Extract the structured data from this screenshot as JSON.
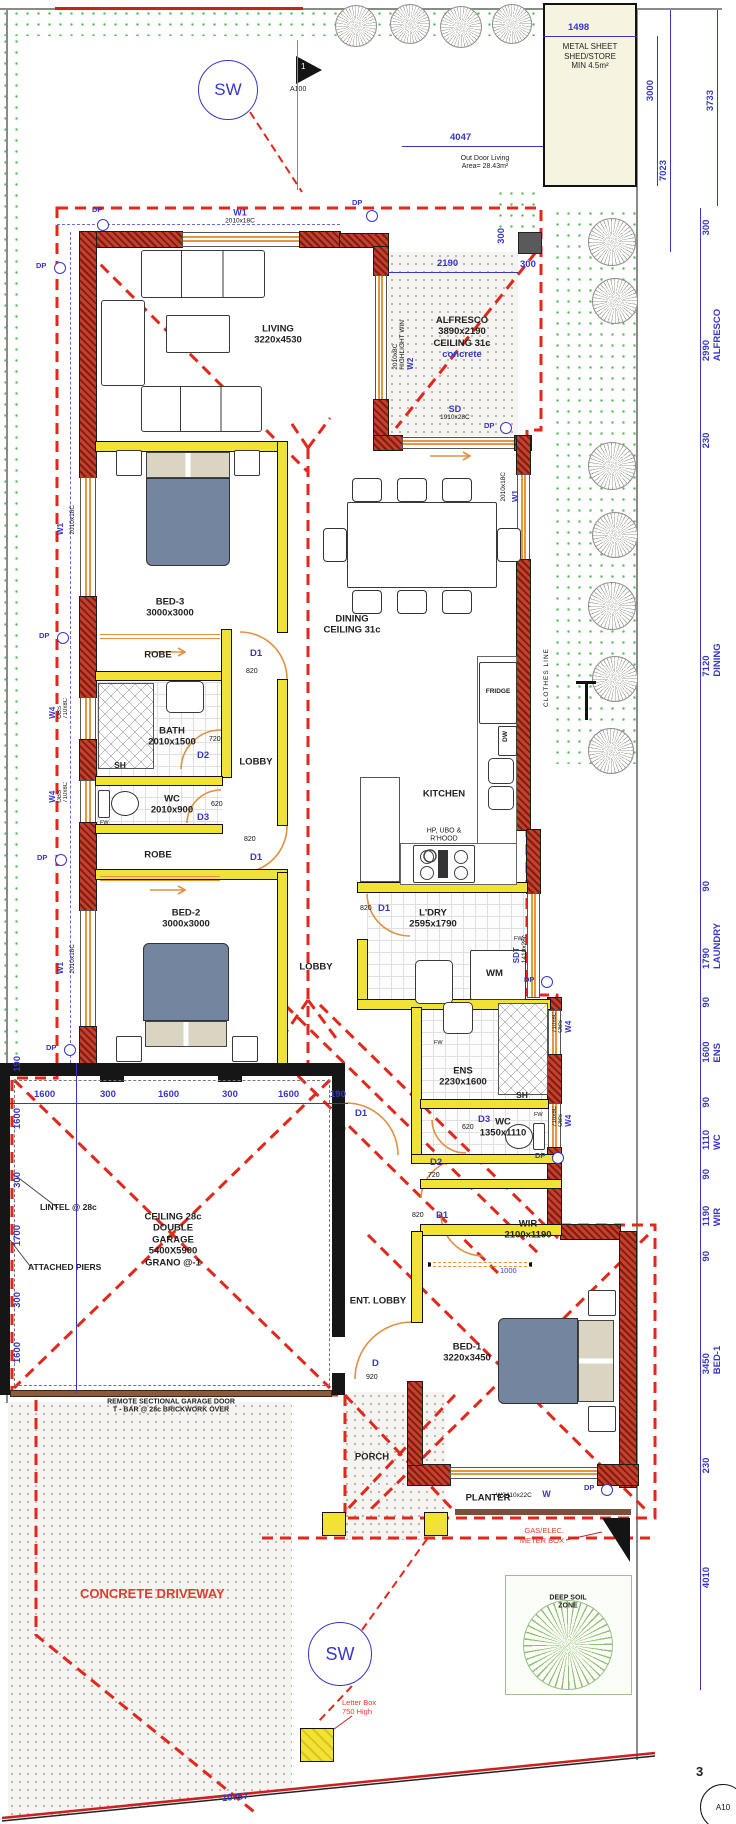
{
  "site": {
    "shed": {
      "line1": "METAL SHEET",
      "line2": "SHED/STORE",
      "line3": "MIN 4.5m²"
    },
    "outdoor_living": {
      "line1": "Out Door Living",
      "line2": "Area= 28.43m²"
    },
    "concrete_driveway": "CONCRETE DRIVEWAY",
    "deep_soil": {
      "line1": "DEEP SOIL",
      "line2": "ZONE"
    },
    "letter_box": {
      "line1": "Letter Box",
      "line2": "750 High"
    },
    "gas_meter": {
      "line1": "GAS/ELEC.",
      "line2": "METER BOX"
    },
    "clothes_line": "CLOTHES LINE",
    "boundary_dim": "10757"
  },
  "markers": {
    "sw_top": "SW",
    "sw_bottom": "SW",
    "north_no": "1",
    "north_sheet": "A100",
    "section_no": "3",
    "section_sheet": "A10"
  },
  "dims": {
    "top": {
      "shed_w": "1498",
      "shed_h": "3000",
      "boundary_h": "3733",
      "outdoor_w": "4047",
      "side_h": "7023"
    },
    "alfresco": {
      "w": "2190",
      "off_h": "300",
      "off_v": "300"
    },
    "garage_h": [
      "1600",
      "300",
      "1600",
      "300",
      "1600",
      "190"
    ],
    "garage_v": [
      "190",
      "1600",
      "300",
      "1700",
      "300",
      "1600"
    ],
    "wir_rail": "1000",
    "right_rail": [
      {
        "v": "300",
        "room": ""
      },
      {
        "v": "2990",
        "room": "ALFRESCO"
      },
      {
        "v": "230",
        "room": ""
      },
      {
        "v": "7120",
        "room": "DINING"
      },
      {
        "v": "90",
        "room": ""
      },
      {
        "v": "1790",
        "room": "LAUNDRY"
      },
      {
        "v": "90",
        "room": ""
      },
      {
        "v": "1600",
        "room": "ENS"
      },
      {
        "v": "90",
        "room": ""
      },
      {
        "v": "1110",
        "room": "WC"
      },
      {
        "v": "90",
        "room": ""
      },
      {
        "v": "1190",
        "room": "WIR"
      },
      {
        "v": "90",
        "room": ""
      },
      {
        "v": "3450",
        "room": "BED-1"
      },
      {
        "v": "230",
        "room": ""
      },
      {
        "v": "4010",
        "room": ""
      }
    ]
  },
  "rooms": {
    "living": {
      "name": "LIVING",
      "size": "3220x4530"
    },
    "alfresco": {
      "name": "ALFRESCO",
      "size": "3890x2190",
      "ceiling": "CEILING 31c",
      "finish": "concrete"
    },
    "dining": {
      "name": "DINING",
      "ceiling": "CEILING 31c"
    },
    "kitchen": {
      "name": "KITCHEN"
    },
    "ldry": {
      "name": "L'DRY",
      "size": "2595x1790"
    },
    "bed3": {
      "name": "BED-3",
      "size": "3000x3000"
    },
    "bed2": {
      "name": "BED-2",
      "size": "3000x3000"
    },
    "bed1": {
      "name": "BED-1",
      "size": "3220x3450"
    },
    "bath": {
      "name": "BATH",
      "size": "2010x1500"
    },
    "wc1": {
      "name": "WC",
      "size": "2010x900"
    },
    "wc2": {
      "name": "WC",
      "size": "1350x1110"
    },
    "ens": {
      "name": "ENS",
      "size": "2230x1600"
    },
    "wir": {
      "name": "WIR",
      "size": "2100x1190"
    },
    "robe3": "ROBE",
    "robe2": "ROBE",
    "lobby1": "LOBBY",
    "lobby2": "LOBBY",
    "ent_lobby": "ENT. LOBBY",
    "porch": "PORCH",
    "planter": "PLANTER",
    "sh_bath": "SH",
    "sh_ens": "SH",
    "garage": {
      "l1": "CEILING 28c",
      "l2": "DOUBLE",
      "l3": "GARAGE",
      "l4": "5400X5900",
      "l5": "GRANO @-1"
    }
  },
  "fixtures": {
    "fridge": "FRIDGE",
    "dw": "DW",
    "wm": "WM",
    "cooktop1": "HP, UBO &",
    "cooktop2": "R'HOOD",
    "fw": "FW",
    "dp": "DP"
  },
  "doors": {
    "bed3": {
      "tag": "D1",
      "w": "820"
    },
    "bed2": {
      "tag": "D1",
      "w": "820"
    },
    "bath": {
      "tag": "D2",
      "w": "720"
    },
    "wc1": {
      "tag": "D3",
      "w": "620"
    },
    "ldry": {
      "tag": "D1",
      "w": "820"
    },
    "hall": {
      "tag": "D1",
      "w": "820"
    },
    "ens": {
      "tag": "D2",
      "w": "720"
    },
    "wc2": {
      "tag": "D3",
      "w": "620"
    },
    "wir": {
      "tag": "D1",
      "w": "820"
    },
    "entry": {
      "tag": "D",
      "w": "920"
    }
  },
  "windows": {
    "w1_top": {
      "tag": "W1",
      "size": "2010x18C"
    },
    "w1_bed3": {
      "tag": "W1",
      "size": "2010x18C"
    },
    "w1_bed2": {
      "tag": "W1",
      "size": "2010x18C"
    },
    "w1_dining": {
      "tag": "W1",
      "size": "2010x18C"
    },
    "w2": {
      "tag": "W2",
      "size": "2010x8C",
      "note": "HIGHLIGHT WIN"
    },
    "w4_bath": {
      "tag": "W4",
      "note": "OBS",
      "size": "710x8C"
    },
    "w4_wc": {
      "tag": "W4",
      "note": "OBS",
      "size": "710x8C"
    },
    "w4_ens": {
      "tag": "W4",
      "note": "OBS",
      "size": "710x8C"
    },
    "w4_wc2": {
      "tag": "W4",
      "note": "OBS",
      "size": "710x8C"
    },
    "sd": {
      "tag": "SD",
      "size": "1910x28C"
    },
    "sdt": {
      "tag": "SDT",
      "size": "1410x28c"
    },
    "w_bed1": {
      "tag": "W",
      "size": "W2410x22C"
    }
  },
  "garage_annots": {
    "lintel": "LINTEL @ 28c",
    "piers": "ATTACHED PIERS",
    "door_l1": "REMOTE SECTIONAL GARAGE DOOR",
    "door_l2": "T - BAR @ 28c BRICKWORK OVER"
  }
}
